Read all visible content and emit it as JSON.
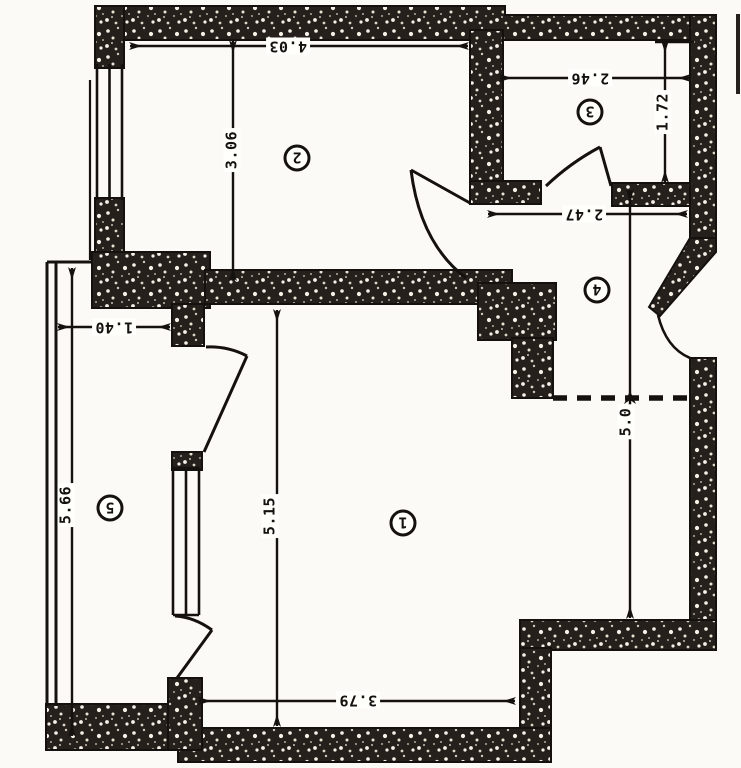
{
  "plan": {
    "title": "apartment-floor-plan-scan",
    "dims": {
      "room2_width": "4.03",
      "room2_height": "3.06",
      "room3_width": "2.46",
      "room3_height": "1.72",
      "hall_width": "2.47",
      "balcony_width": "1.40",
      "balcony_length": "5.66",
      "room1_height": "5.15",
      "right_section_height": "5.0",
      "room1_width": "3.79"
    },
    "rooms": {
      "room1": "1",
      "room2": "2",
      "room3": "3",
      "room4": "4",
      "room5": "5"
    },
    "colors": {
      "paper": "#fbfaf7",
      "ink": "#181512",
      "wall_fill": "#282420",
      "wall_speckle": "#f1ece3"
    }
  }
}
